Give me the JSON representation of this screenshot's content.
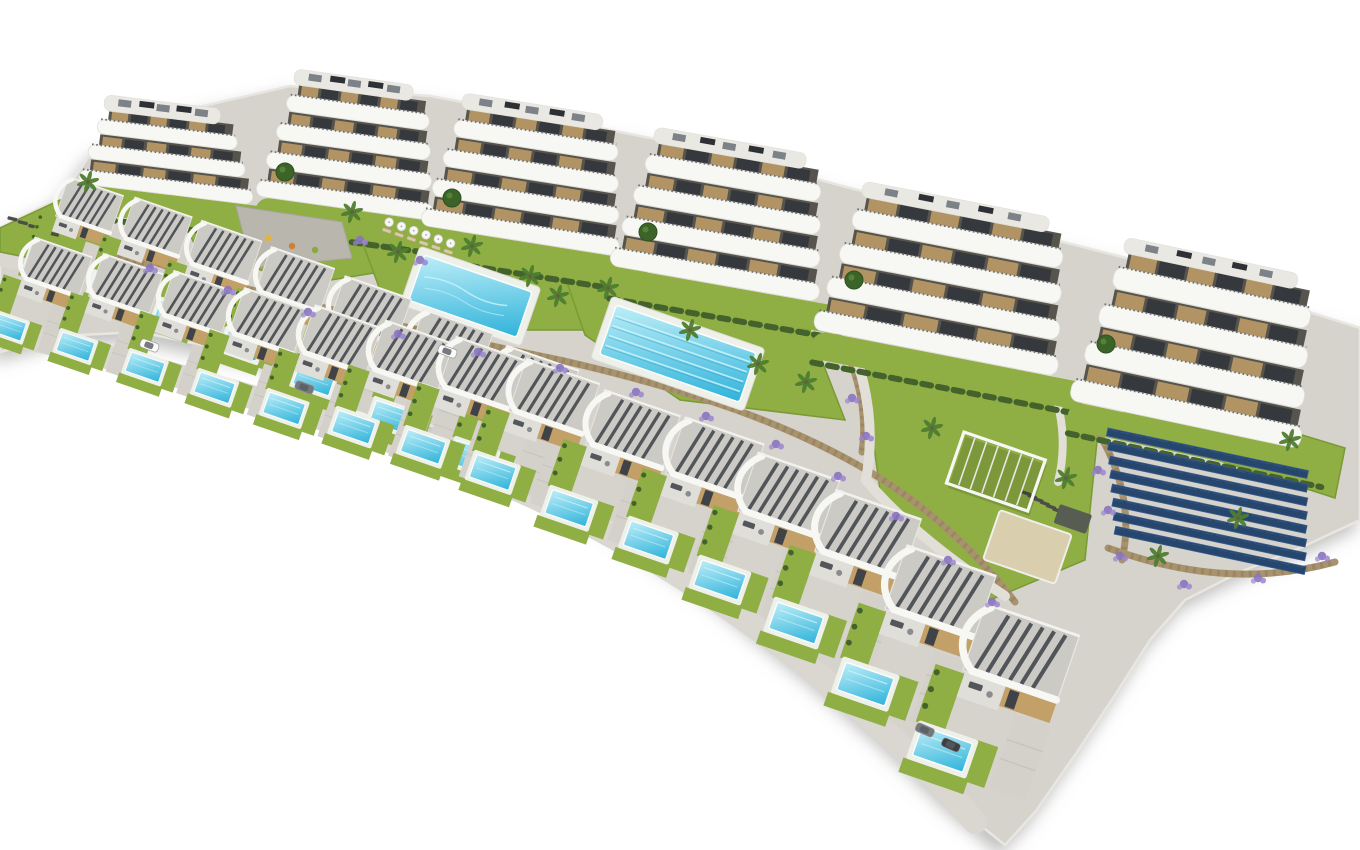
{
  "scene": {
    "description": "Aerial 3D architectural rendering of a hillside residential development: six curved white apartment buildings along the top, two diagonal rows of modern white villas with private pools below, communal swimming pools, lawns, playground, pergola, sand court, stone retaining walls with purple flowering shrubs, palm trees and a solar panel field, all on a plain white background",
    "background": "#ffffff",
    "palette": {
      "base": "#d6d3cc",
      "baseEdge": "#e8e6e1",
      "lawn": "#8fae43",
      "lawnDeep": "#7a9a36",
      "hedge": "#44622b",
      "poolTop": "#bdeef8",
      "poolBottom": "#2fb3da",
      "poolRim": "#fdfdfc",
      "lane": "#cff2fa",
      "laneRope": "#2a9cc2",
      "roofGravel": "#cbcac5",
      "slat": "#44494f",
      "white": "#f7f7f4",
      "whiteShade": "#e0ded8",
      "tan": "#c2a068",
      "tanDark": "#a5854f",
      "stone": "#a8936f",
      "stoneDark": "#8d7753",
      "path": "#dad7d1",
      "pathLight": "#e2dfd9",
      "drive": "#d4d1cb",
      "purple": "#8a74c0",
      "purpleLight": "#9a86cf",
      "treeGreen": "#3c6428",
      "palmGreen": "#4f7d30",
      "trunk": "#6b5a3e",
      "solar": "#27466e",
      "solarLight": "#3a5d8c",
      "interior": "#56544c",
      "windowDark": "#2f3439",
      "roofBand": "#e9e8e3",
      "hvac": "#7c8288",
      "hvacDark": "#2d3135",
      "sand": "#d9cfae",
      "mat": "#585d53",
      "carWhite": "#fafafa",
      "carGrey": "#73787d",
      "carDark": "#3c4045",
      "shadow": "#8f8d8a"
    },
    "site_outline": "M 0,228 L 60,198 L 92,152 L 160,116 L 290,86 L 430,96 L 560,120 L 700,148 L 850,188 L 1000,226 L 1150,264 L 1290,306 L 1360,328 L 1360,520 L 1300,548 L 1240,572 L 1185,600 L 1150,640 L 1115,695 L 1075,755 L 1035,812 L 1005,845 L 955,805 L 890,742 L 810,672 L 715,595 L 610,522 L 500,458 L 385,404 L 265,358 L 140,332 L 60,336 L 0,352 Z",
    "lawn_patches": [
      {
        "pts": "0,228 60,200 96,214 102,248 40,260 0,252"
      },
      {
        "pts": "170,195 360,225 380,272 300,285 195,245"
      },
      {
        "pts": "355,222 565,262 590,330 460,330 380,290"
      },
      {
        "pts": "560,262 810,330 845,420 680,400 585,335"
      },
      {
        "pts": "860,345 1100,412 1085,560 990,600 880,490"
      },
      {
        "pts": "1115,378 1345,448 1335,498 1130,432"
      }
    ],
    "stone_walls": [
      {
        "d": "M 118,256 C 280,298 420,332 560,360 C 700,392 790,425 870,472 C 930,508 980,556 1015,602"
      },
      {
        "d": "M 838,332 C 858,372 868,412 862,452"
      },
      {
        "d": "M 1108,548 C 1180,574 1255,584 1335,562"
      },
      {
        "d": "M 1098,432 C 1122,472 1132,516 1122,560"
      }
    ],
    "roads": [
      {
        "d": "M -8,330 C 140,362 300,408 450,462 C 600,518 720,596 830,684 C 890,734 940,782 975,822",
        "w": 24,
        "c": "path"
      },
      {
        "d": "M -8,258 C 120,286 260,322 380,360 C 440,380 490,398 530,418",
        "w": 13,
        "c": "path"
      },
      {
        "d": "M 845,330 C 868,380 875,430 866,480 C 900,520 950,560 1005,596",
        "w": 10,
        "c": "pathLight"
      },
      {
        "d": "M 1042,362 C 1062,402 1068,442 1058,482",
        "w": 8,
        "c": "pathLight"
      }
    ],
    "apartment_buildings": [
      {
        "x": 100,
        "y": 104,
        "w": 175,
        "h": 102,
        "rot": 7,
        "floors": 3
      },
      {
        "x": 290,
        "y": 78,
        "w": 178,
        "h": 142,
        "rot": 8,
        "floors": 4
      },
      {
        "x": 458,
        "y": 102,
        "w": 200,
        "h": 148,
        "rot": 9,
        "floors": 4
      },
      {
        "x": 650,
        "y": 136,
        "w": 212,
        "h": 155,
        "rot": 10,
        "floors": 4
      },
      {
        "x": 858,
        "y": 190,
        "w": 248,
        "h": 166,
        "rot": 11,
        "floors": 4
      },
      {
        "x": 1120,
        "y": 246,
        "w": 235,
        "h": 182,
        "rot": 12,
        "floors": 4
      }
    ],
    "community_pools": [
      {
        "x": 420,
        "y": 246,
        "rot": 19,
        "deck_w": 128,
        "deck_h": 62,
        "lanes": 0
      },
      {
        "x": 612,
        "y": 296,
        "rot": 19,
        "deck_w": 162,
        "deck_h": 66,
        "lanes": 4
      }
    ],
    "umbrella_row": {
      "x": 386,
      "y": 219,
      "rot": 19,
      "count": 6,
      "step": 13
    },
    "lounger_rows": [
      {
        "x": 1022,
        "y": 490,
        "rot": 19,
        "count": 7,
        "step": 7
      },
      {
        "x": 8,
        "y": 216,
        "rot": 14,
        "count": 5,
        "step": 11
      }
    ],
    "playground": {
      "pts": "236,206 342,222 352,258 252,268",
      "dots": [
        {
          "x": 268,
          "y": 238,
          "c": "#e5b33a"
        },
        {
          "x": 292,
          "y": 246,
          "c": "#d07f35"
        },
        {
          "x": 315,
          "y": 250,
          "c": "#8aa83c"
        },
        {
          "x": 255,
          "y": 252,
          "c": "#b9524a"
        }
      ]
    },
    "pergola": {
      "x": 964,
      "y": 432,
      "rot": 19,
      "w": 86,
      "h": 54
    },
    "sand_court": {
      "x": 1000,
      "y": 510,
      "rot": 19,
      "w": 76,
      "h": 52
    },
    "mat": {
      "x": 1060,
      "y": 504,
      "rot": 19,
      "w": 34,
      "h": 20
    },
    "solar_field": {
      "x": 1108,
      "y": 428,
      "rot": 12,
      "rows": 8,
      "row_w": 205,
      "row_h": 8,
      "dx": 4,
      "dy": 13.5
    },
    "villa_rows": [
      {
        "name": "upper-villa-row",
        "villas": [
          [
            55,
            172,
            0.74
          ],
          [
            120,
            192,
            0.78
          ],
          [
            186,
            215,
            0.82
          ],
          [
            255,
            241,
            0.86
          ],
          [
            328,
            270,
            0.9
          ],
          [
            406,
            303,
            0.94
          ],
          [
            488,
            339,
            0.98
          ]
        ]
      },
      {
        "name": "lower-villa-row",
        "villas": [
          [
            20,
            232,
            0.78
          ],
          [
            88,
            248,
            0.81
          ],
          [
            158,
            265,
            0.84
          ],
          [
            228,
            282,
            0.87
          ],
          [
            298,
            299,
            0.9
          ],
          [
            368,
            314,
            0.93
          ],
          [
            438,
            330,
            0.96
          ],
          [
            508,
            352,
            0.99
          ],
          [
            585,
            383,
            1.03
          ],
          [
            665,
            410,
            1.07
          ],
          [
            737,
            445,
            1.11
          ],
          [
            814,
            482,
            1.16
          ],
          [
            884,
            537,
            1.21
          ],
          [
            962,
            595,
            1.27
          ]
        ]
      }
    ],
    "villa_rot": 19,
    "cars": [
      {
        "x": 142,
        "y": 338,
        "rot": 20,
        "c": "carWhite"
      },
      {
        "x": 297,
        "y": 380,
        "rot": 20,
        "c": "carGrey"
      },
      {
        "x": 440,
        "y": 344,
        "rot": 20,
        "c": "carWhite"
      },
      {
        "x": 918,
        "y": 722,
        "rot": 24,
        "c": "carGrey"
      },
      {
        "x": 944,
        "y": 737,
        "rot": 24,
        "c": "carDark"
      }
    ],
    "round_trees": [
      [
        285,
        172
      ],
      [
        452,
        198
      ],
      [
        648,
        232
      ],
      [
        854,
        280
      ],
      [
        1106,
        344
      ]
    ],
    "palms": [
      [
        88,
        182
      ],
      [
        352,
        212
      ],
      [
        398,
        252
      ],
      [
        472,
        246
      ],
      [
        530,
        276
      ],
      [
        558,
        296
      ],
      [
        608,
        288
      ],
      [
        690,
        330
      ],
      [
        758,
        364
      ],
      [
        806,
        382
      ],
      [
        932,
        428
      ],
      [
        1066,
        478
      ],
      [
        1158,
        556
      ],
      [
        1290,
        440
      ],
      [
        1238,
        518
      ]
    ],
    "flower_patches": [
      [
        150,
        268
      ],
      [
        228,
        290
      ],
      [
        308,
        312
      ],
      [
        398,
        334
      ],
      [
        478,
        352
      ],
      [
        560,
        368
      ],
      [
        636,
        392
      ],
      [
        706,
        416
      ],
      [
        776,
        444
      ],
      [
        838,
        476
      ],
      [
        896,
        516
      ],
      [
        948,
        560
      ],
      [
        992,
        602
      ],
      [
        852,
        398
      ],
      [
        866,
        436
      ],
      [
        1120,
        556
      ],
      [
        1184,
        584
      ],
      [
        1258,
        578
      ],
      [
        1322,
        556
      ],
      [
        1098,
        470
      ],
      [
        1108,
        510
      ],
      [
        360,
        240
      ],
      [
        420,
        260
      ]
    ]
  }
}
